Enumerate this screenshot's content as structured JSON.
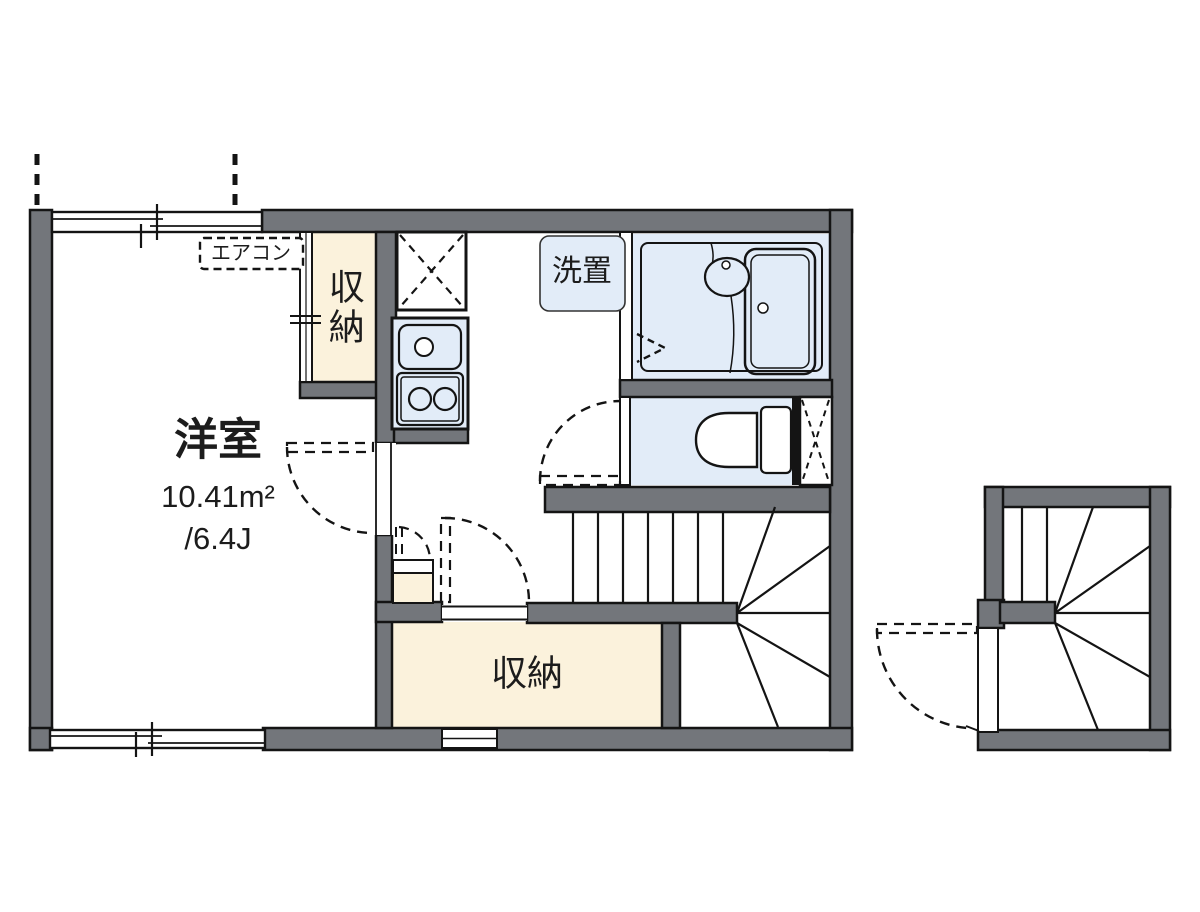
{
  "plan": {
    "rooms": {
      "main_room": {
        "label": "洋室",
        "area_sqm": "10.41m²",
        "area_tatami": "/6.4J"
      },
      "closet_upper": {
        "label": "収納"
      },
      "closet_lower": {
        "label": "収納"
      },
      "washer_space": {
        "label": "洗置"
      },
      "air_conditioner": {
        "label": "エアコン"
      }
    },
    "colors": {
      "wall": "#73767b",
      "outline": "#141414",
      "closet-fill": "#fbf2dc",
      "water-fill": "#e2ecf8",
      "floor": "#ffffff",
      "text": "#1c1c1c"
    },
    "icons": [
      "air-conditioner",
      "sliding-closet-door",
      "refrigerator-space",
      "kitchen-sink",
      "gas-stove",
      "washer-space",
      "bathtub",
      "wash-basin",
      "bath-folding-door",
      "toilet",
      "pipe-space",
      "staircase-upper",
      "staircase-lower",
      "door-swing",
      "sliding-window",
      "upper-floor-projection"
    ]
  }
}
